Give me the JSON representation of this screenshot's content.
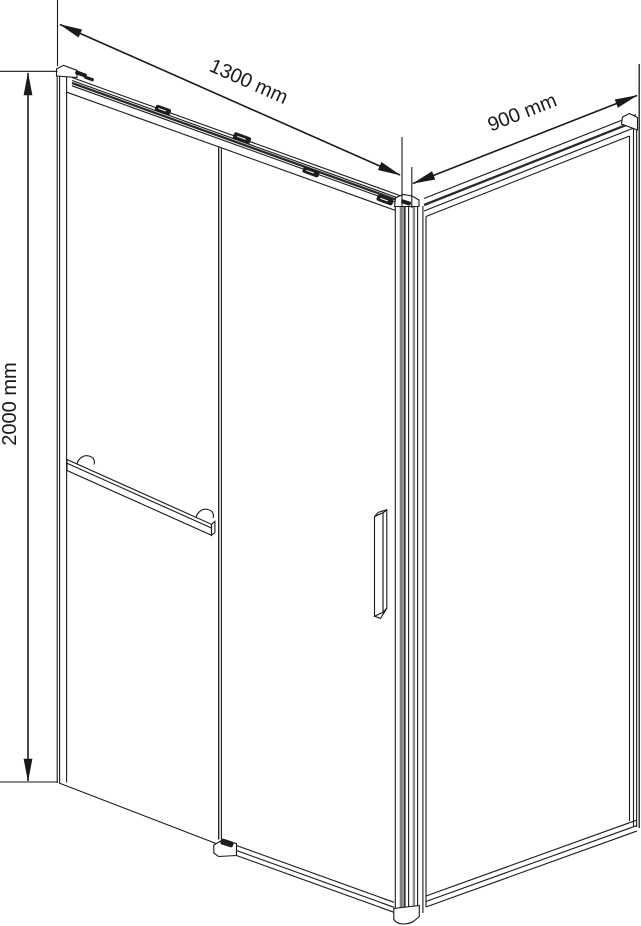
{
  "drawing": {
    "kind": "corner shower enclosure dimensional drawing",
    "labels": {
      "front_width": "1300 mm",
      "side_width": "900 mm",
      "height": "2000 mm"
    },
    "values": {
      "front_width_mm": 1300,
      "side_width_mm": 900,
      "height_mm": 2000,
      "unit": "mm"
    },
    "colors": {
      "background": "#ffffff",
      "line": "#1a1a1a",
      "profile_gray": "#7d7d7d",
      "profile_dark": "#383838"
    }
  }
}
